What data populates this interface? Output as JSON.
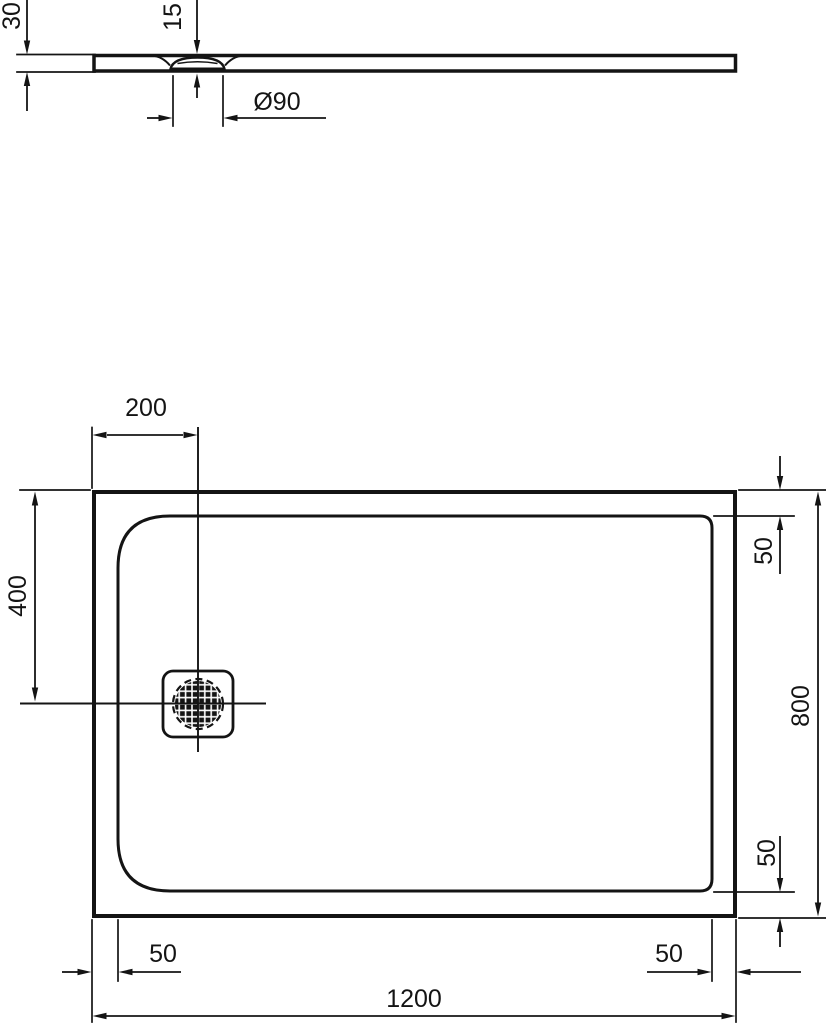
{
  "drawing": {
    "section_view": {
      "thickness": "30",
      "recess_depth": "15",
      "drain_diameter": "Ø90"
    },
    "plan_view": {
      "drain_offset_from_left": "200",
      "drain_offset_from_top": "400",
      "tray_length": "1200",
      "tray_width": "800",
      "right_edge_inset_top": "50",
      "right_edge_inset_bottom": "50",
      "bottom_edge_inset_left": "50",
      "bottom_edge_inset_right": "50"
    },
    "colors": {
      "line": "#141414",
      "background": "#ffffff"
    }
  }
}
